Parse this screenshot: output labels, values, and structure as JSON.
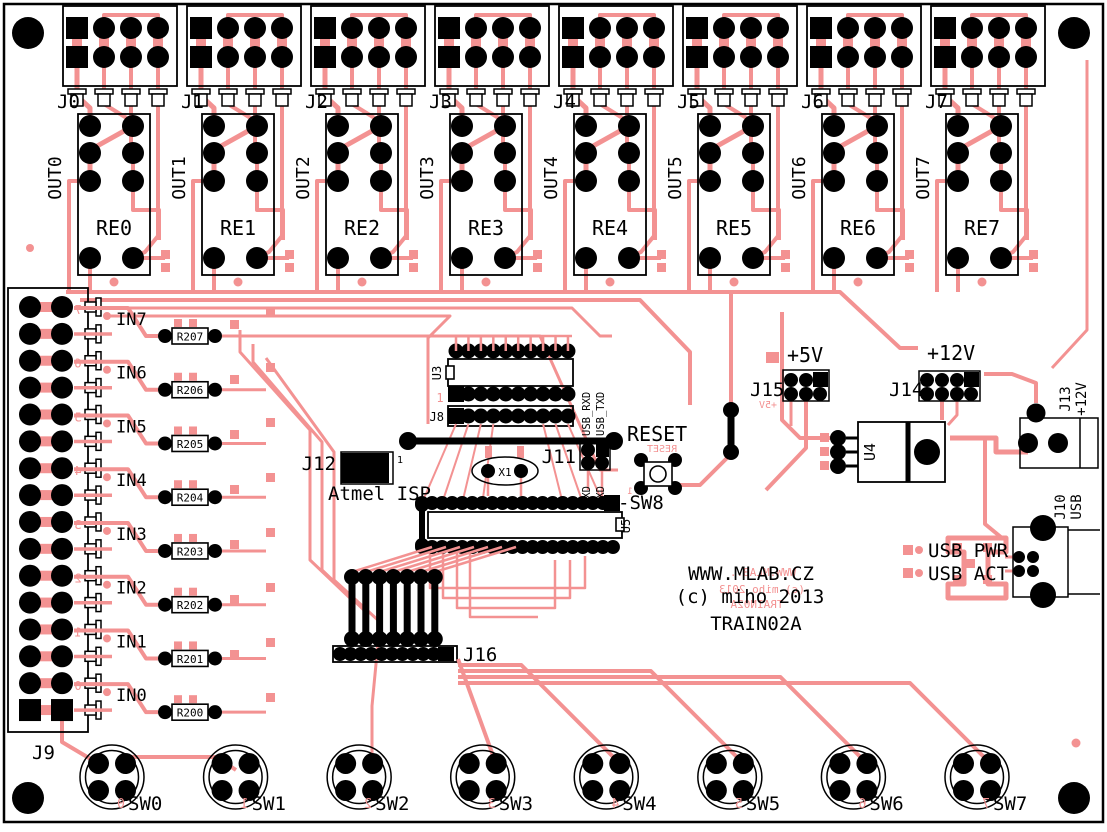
{
  "board": {
    "colors": {
      "copper": "#F39292",
      "silkscreen": "#000000",
      "background": "#FFFFFF"
    },
    "title_lines": [
      "WWW.MLAB.CZ",
      "(c) miho 2013",
      "TRAIN02A"
    ],
    "copper_mirror_title_lines": [
      "WWW.MLAB..",
      "(c) miho 2013",
      "TRAIN02A"
    ]
  },
  "relay_channels": [
    {
      "connector": "J0",
      "relay": "RE0",
      "output": "OUT0"
    },
    {
      "connector": "J1",
      "relay": "RE1",
      "output": "OUT1"
    },
    {
      "connector": "J2",
      "relay": "RE2",
      "output": "OUT2"
    },
    {
      "connector": "J3",
      "relay": "RE3",
      "output": "OUT3"
    },
    {
      "connector": "J4",
      "relay": "RE4",
      "output": "OUT4"
    },
    {
      "connector": "J5",
      "relay": "RE5",
      "output": "OUT5"
    },
    {
      "connector": "J6",
      "relay": "RE6",
      "output": "OUT6"
    },
    {
      "connector": "J7",
      "relay": "RE7",
      "output": "OUT7"
    }
  ],
  "input_section": {
    "connector": "J9",
    "channels": [
      {
        "label": "IN7",
        "resistor": "R207",
        "copper_pin": "7"
      },
      {
        "label": "IN6",
        "resistor": "R206",
        "copper_pin": "6"
      },
      {
        "label": "IN5",
        "resistor": "R205",
        "copper_pin": "5"
      },
      {
        "label": "IN4",
        "resistor": "R204",
        "copper_pin": "4"
      },
      {
        "label": "IN3",
        "resistor": "R203",
        "copper_pin": "3"
      },
      {
        "label": "IN2",
        "resistor": "R202",
        "copper_pin": "2"
      },
      {
        "label": "IN1",
        "resistor": "R201",
        "copper_pin": "1"
      },
      {
        "label": "IN0",
        "resistor": "R200",
        "copper_pin": "0"
      }
    ]
  },
  "switch_section": {
    "header": "J16",
    "switches": [
      {
        "label": "SW0",
        "copper_digit": "0"
      },
      {
        "label": "SW1",
        "copper_digit": "1"
      },
      {
        "label": "SW2",
        "copper_digit": "2"
      },
      {
        "label": "SW3",
        "copper_digit": "3"
      },
      {
        "label": "SW4",
        "copper_digit": "4"
      },
      {
        "label": "SW5",
        "copper_digit": "5"
      },
      {
        "label": "SW6",
        "copper_digit": "6"
      },
      {
        "label": "SW7",
        "copper_digit": "7"
      }
    ]
  },
  "mcu": {
    "ic_u3": "U3",
    "header_j8": "J8",
    "ic_u5": "U5",
    "pin1_mark": "1"
  },
  "crystal": {
    "ref": "X1"
  },
  "isp": {
    "ref": "J12",
    "label": "Atmel ISP",
    "pin1_mark": "1"
  },
  "serial_header": {
    "ref": "J11",
    "top_labels": [
      "USB_RXD",
      "USB_TXD"
    ],
    "bottom_labels": [
      "TXD",
      "RXD"
    ]
  },
  "reset": {
    "label": "RESET",
    "switch_label": "-SW8",
    "copper_mirror": "RESET",
    "pin1_mark": "1"
  },
  "power": {
    "j15": {
      "ref": "J15",
      "label": "+5V",
      "copper_mirror": "+5V"
    },
    "j14": {
      "ref": "J14",
      "label": "+12V"
    },
    "regulator": "U4",
    "j13": {
      "ref": "J13",
      "label": "+12V"
    },
    "usb": {
      "ref": "J10",
      "label": "USB",
      "pwr_led": "USB PWR",
      "act_led": "USB ACT"
    }
  }
}
